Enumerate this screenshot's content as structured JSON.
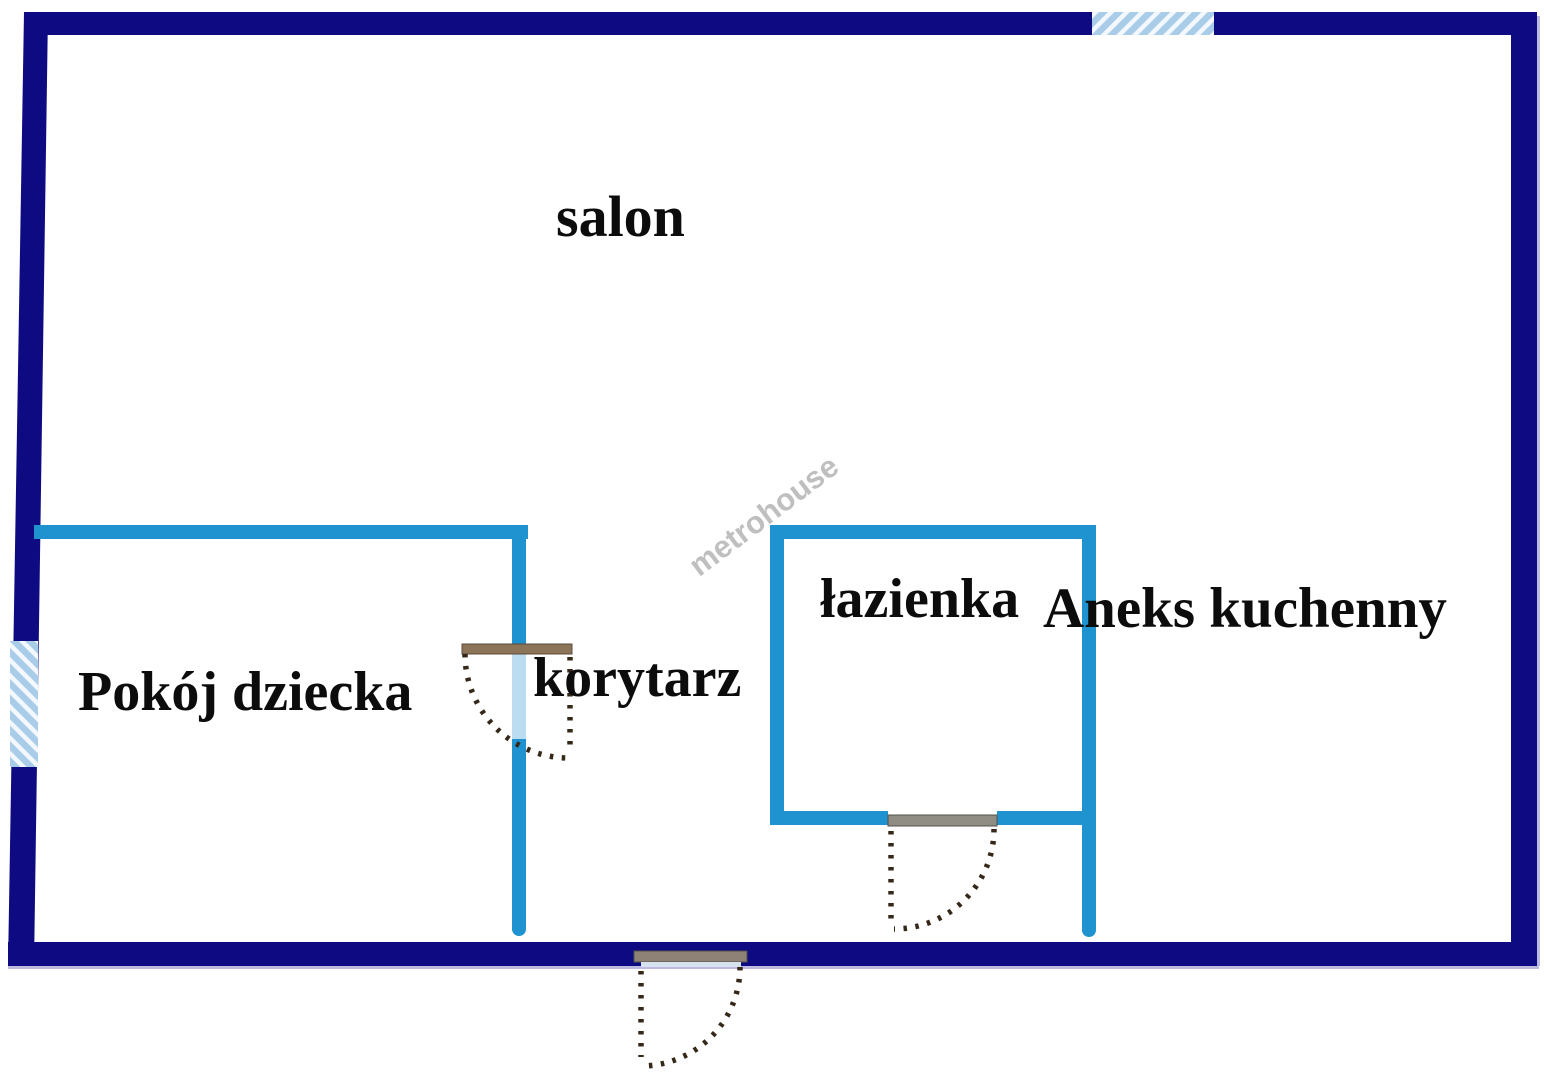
{
  "plan": {
    "type": "apartment-floor-plan",
    "watermark": {
      "text": "metrohouse"
    },
    "rooms": {
      "salon": {
        "label": "salon"
      },
      "pokoj_dziecka": {
        "label": "Pokój dziecka"
      },
      "korytarz": {
        "label": "korytarz"
      },
      "lazienka": {
        "label": "łazienka"
      },
      "aneks_kuchenny": {
        "label": "Aneks kuchenny"
      }
    },
    "features": {
      "windows": [
        "top-wall-window",
        "left-wall-window"
      ],
      "doors": [
        "korytarz-door",
        "lazienka-door",
        "entrance-door"
      ]
    },
    "colors": {
      "outer_wall": "#0e0b82",
      "inner_wall": "#1e93cf",
      "window_hatch_fill": "#a9cce9",
      "window_hatch_stripe": "#f2f8fd",
      "door_opening": "#bcdcf2",
      "door_lintel_brown": "#8b7458",
      "door_lintel_gray": "#908d85",
      "door_swing": "#362819",
      "label_text": "#0c0c0c",
      "watermark_gray": "#b5b5b5",
      "wall_shadow": "#bcb9e2",
      "background": "#ffffff"
    }
  }
}
